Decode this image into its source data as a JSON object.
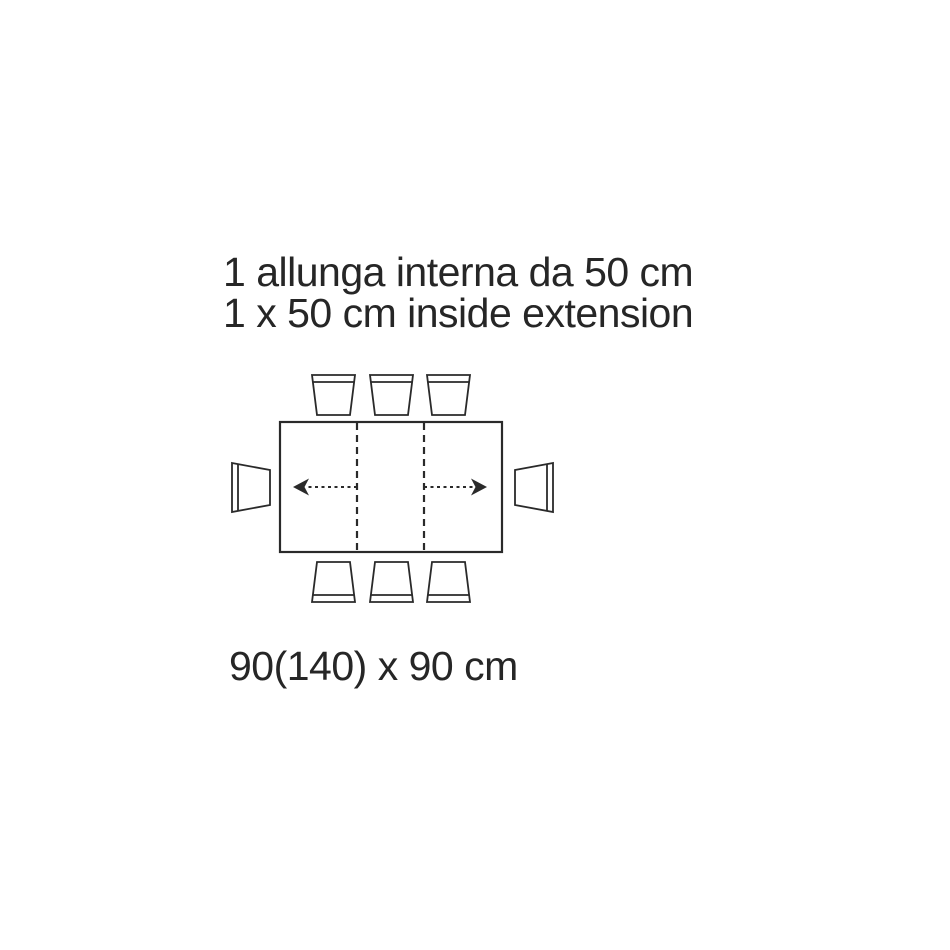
{
  "page": {
    "background_color": "#ffffff",
    "line_color": "#2a2a2a",
    "text_color": "#262626"
  },
  "caption": {
    "line1_it": "1 allunga interna da 50 cm",
    "line2_en": "1 x 50 cm inside extension"
  },
  "dimensions_label": "90(140) x 90 cm",
  "diagram": {
    "type": "extendable-table-top-view",
    "table": {
      "length_closed_cm": 90,
      "length_extended_cm": 140,
      "depth_cm": 90,
      "extension_count": 1,
      "extension_size_cm": 50,
      "extension_type": "inside"
    },
    "chairs": {
      "top_count": 3,
      "bottom_count": 3,
      "left_count": 1,
      "right_count": 1,
      "total": 8
    },
    "extension_markers": {
      "dashed_leaf_lines": 2,
      "arrows": [
        "left",
        "right"
      ]
    }
  }
}
